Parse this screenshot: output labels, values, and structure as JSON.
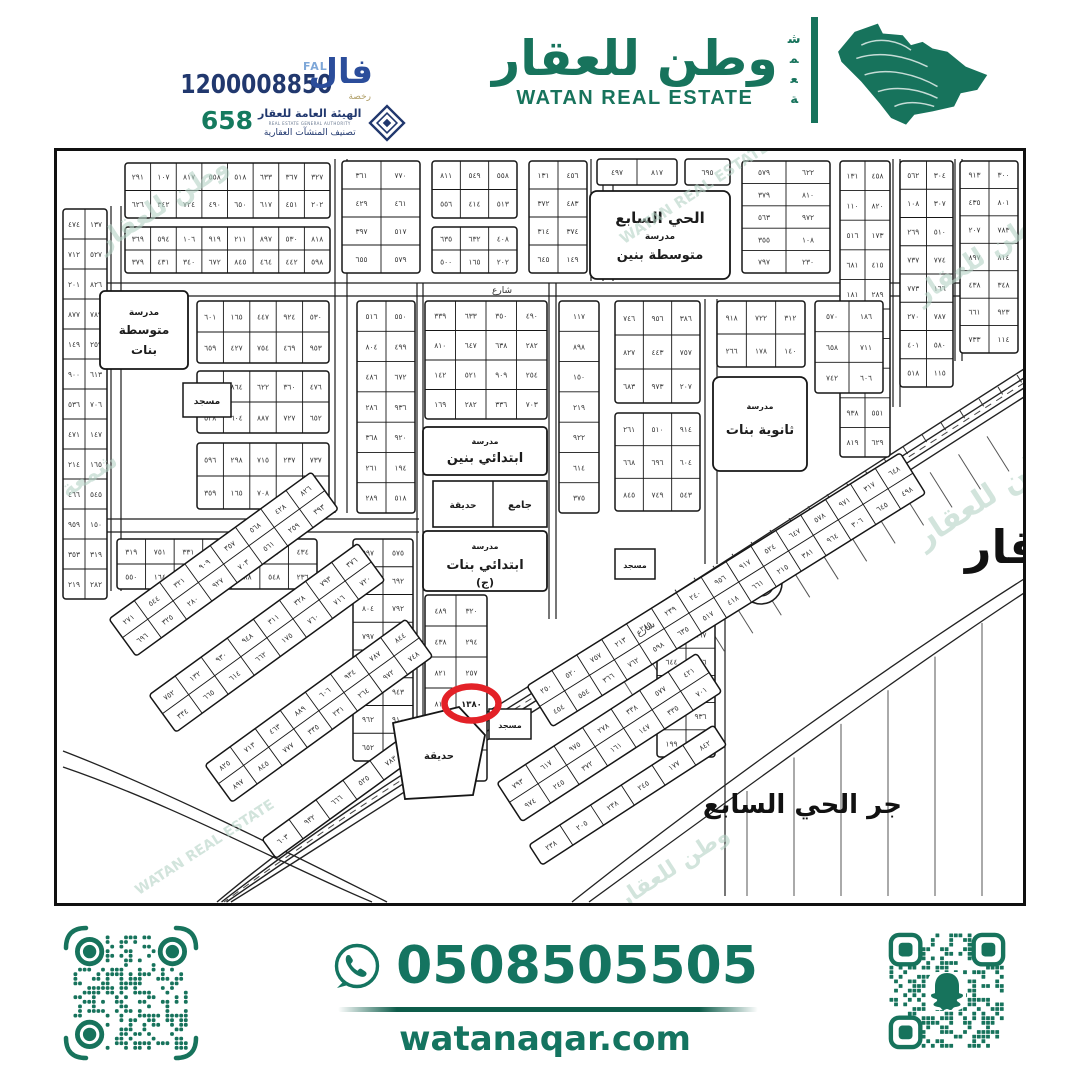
{
  "header": {
    "license_number": "1200008850",
    "classification_number": "658",
    "fal": {
      "arabic": "فال",
      "latin": "FAL",
      "sub": "رخصة"
    },
    "authority": {
      "name_ar": "الهيئة العامة للعقار",
      "name_en": "REAL ESTATE GENERAL AUTHORITY",
      "tagline_ar": "تصنيف المنشآت العقارية"
    },
    "brand": {
      "name_ar": "وطن للعقار",
      "name_en": "WATAN REAL ESTATE",
      "side_word": "شمعة"
    }
  },
  "map": {
    "district_block": {
      "line1": "الحي السابع",
      "line2": "مدرسة",
      "line3": "متوسطة بنين"
    },
    "girls_intermediate": {
      "line1": "مدرسة",
      "line2": "متوسطة",
      "line3": "بنات"
    },
    "boys_elementary": {
      "line1": "مدرسة",
      "line2": "ابتدائي بنين"
    },
    "girls_elementary": {
      "line1": "مدرسة",
      "line2": "ابتدائي بنات",
      "line3": "(ج)"
    },
    "girls_secondary": {
      "line1": "مدرسة",
      "line2": "ثانوية بنات"
    },
    "grand_mosque": "جامع",
    "mosque": "مسجد",
    "park": "حديقة",
    "street": "شارع",
    "bottom_right_label": "جر الحي السابع",
    "right_edge_label": "قار",
    "highlighted_plot_number": "١٣٨٠",
    "highlight_color": "#e32127"
  },
  "footer": {
    "phone": "0508505505",
    "website": "watanaqar.com"
  },
  "colors": {
    "brand_green": "#17735c",
    "navy": "#21386e",
    "fal_blue": "#2b4d9b",
    "watermark_green": "#b5d3c6"
  }
}
